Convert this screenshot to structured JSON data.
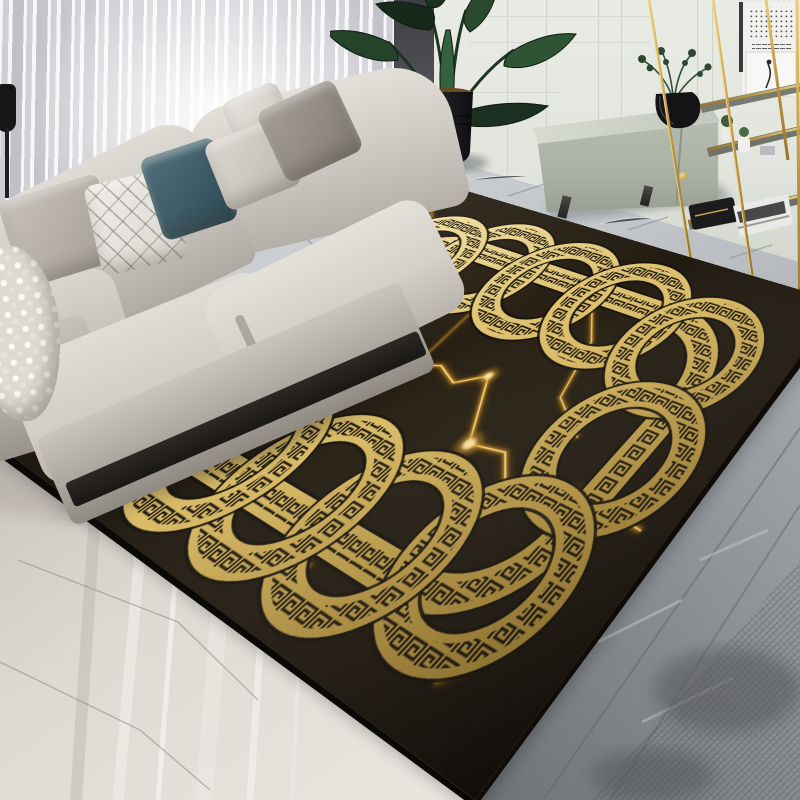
{
  "scene": {
    "type": "photograph",
    "setting": "modern living room with a black and gold greek-key baroque area rug on marble floor",
    "objects": [
      "sheer-curtains",
      "beige-sofa",
      "throw-pillows",
      "knit-throw",
      "floor-lamp",
      "strelitzia-plant",
      "black-planter",
      "sage-sideboard",
      "eucalyptus-vase",
      "gold-etagere",
      "wall-art",
      "marble-floor",
      "black-gold-rug"
    ]
  },
  "palette": {
    "rug_black": "#171108",
    "gold_light": "#f6e7ab",
    "gold_mid": "#d9ba62",
    "gold_dark": "#9a7829",
    "meander_black": "#140d05",
    "vein_bright": "#ffd96e",
    "vein_mid": "#c08424",
    "vein_dark": "#6d4a10",
    "floor_light": "#cdd0d3",
    "floor_dark": "#75787c",
    "marble_left": "#dbd7d0",
    "wall": "#e3e6de",
    "curtain": "#e9e9ec",
    "sofa": "#cdc9c2",
    "teal_pillow": "#3f5d6a",
    "plant_green": "#27452c",
    "brass": "#c09a40"
  },
  "rug": {
    "flat_width": 1000,
    "flat_height": 700,
    "frame": {
      "x": 130,
      "y": 130,
      "w": 740,
      "h": 460,
      "r": 118,
      "band": 46,
      "meander": 26
    },
    "ring_r": 97,
    "ring_band": 44,
    "ring_meander": 25,
    "rings": [
      [
        330,
        154
      ],
      [
        490,
        154
      ],
      [
        650,
        154
      ],
      [
        818,
        182
      ],
      [
        846,
        360
      ],
      [
        818,
        538
      ],
      [
        650,
        566
      ],
      [
        490,
        566
      ],
      [
        330,
        566
      ],
      [
        182,
        538
      ],
      [
        154,
        360
      ],
      [
        182,
        182
      ]
    ],
    "veins": [
      {
        "d": "M40 415 L150 398 L205 452 L300 428 L362 468 L432 362 L472 346 L522 362 L562 332 L642 428 L702 418 L762 468 L832 422 L958 432",
        "w": 3,
        "bright": true
      },
      {
        "d": "M560 120 L660 220 L700 320 L778 362",
        "w": 2.4,
        "bright": true
      },
      {
        "d": "M58 62 L142 122 L182 198 L262 238",
        "w": 2,
        "bright": false
      },
      {
        "d": "M838 470 L902 520 L918 592 L872 648",
        "w": 2.6,
        "bright": true
      },
      {
        "d": "M302 652 L422 638 L502 663 L612 624",
        "w": 1.8,
        "bright": false
      },
      {
        "d": "M120 520 L170 560 L162 602",
        "w": 1.6,
        "bright": false
      },
      {
        "d": "M432 362 L415 255 L438 162",
        "w": 1.8,
        "bright": false
      }
    ],
    "hotspots": [
      [
        562,
        332,
        7
      ],
      [
        642,
        428,
        9
      ],
      [
        762,
        468,
        6
      ],
      [
        902,
        520,
        7
      ],
      [
        205,
        452,
        5
      ],
      [
        502,
        663,
        5
      ]
    ]
  }
}
